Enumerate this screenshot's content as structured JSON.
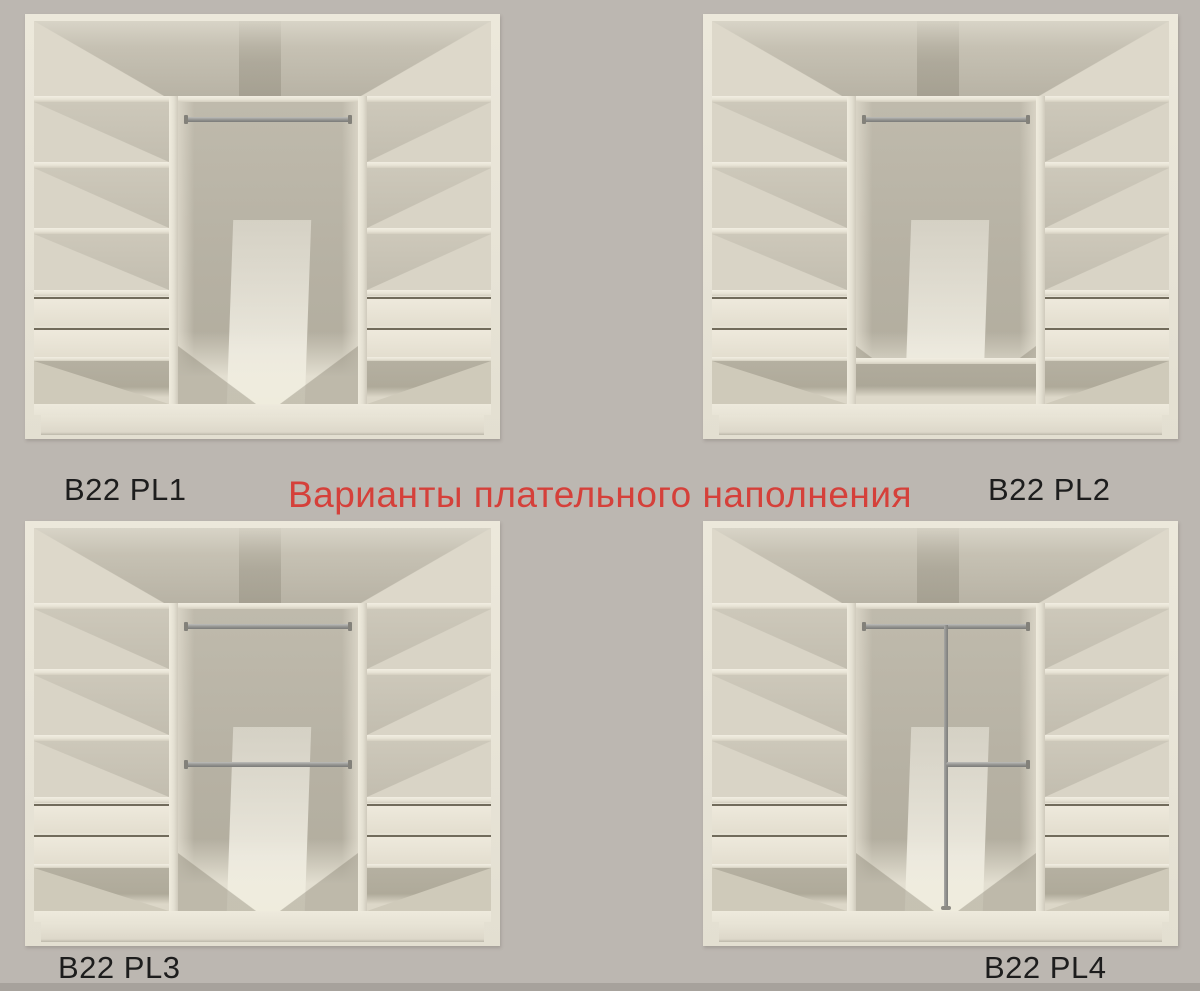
{
  "title": {
    "text": "Варианты плательного наполнения",
    "color": "#d5403a"
  },
  "wardrobes": [
    {
      "label": "B22 PL1",
      "variant": "single top hanging rod, open to floor",
      "features": {
        "top_rod": true,
        "middle_rod": false,
        "bottom_shelf": false,
        "vertical_pole": false,
        "lower_right_rod": false
      }
    },
    {
      "label": "B22 PL2",
      "variant": "single top hanging rod with bottom shelf compartment",
      "features": {
        "top_rod": true,
        "middle_rod": false,
        "bottom_shelf": true,
        "vertical_pole": false,
        "lower_right_rod": false
      }
    },
    {
      "label": "B22 PL3",
      "variant": "two full-width hanging rods",
      "features": {
        "top_rod": true,
        "middle_rod": true,
        "bottom_shelf": false,
        "vertical_pole": false,
        "lower_right_rod": false
      }
    },
    {
      "label": "B22 PL4",
      "variant": "top rod with center vertical pole and half-width lower rod",
      "features": {
        "top_rod": true,
        "middle_rod": false,
        "bottom_shelf": false,
        "vertical_pole": true,
        "lower_right_rod": true
      }
    }
  ],
  "colors": {
    "background": "#bcb7b1",
    "cabinet_front": "#ece8db",
    "cabinet_back": "#b6b1a3",
    "shadow": "#a9a495",
    "rod_metal": "#8f8f8d",
    "label_text": "#1d1d1d",
    "title_red": "#d5403a"
  }
}
